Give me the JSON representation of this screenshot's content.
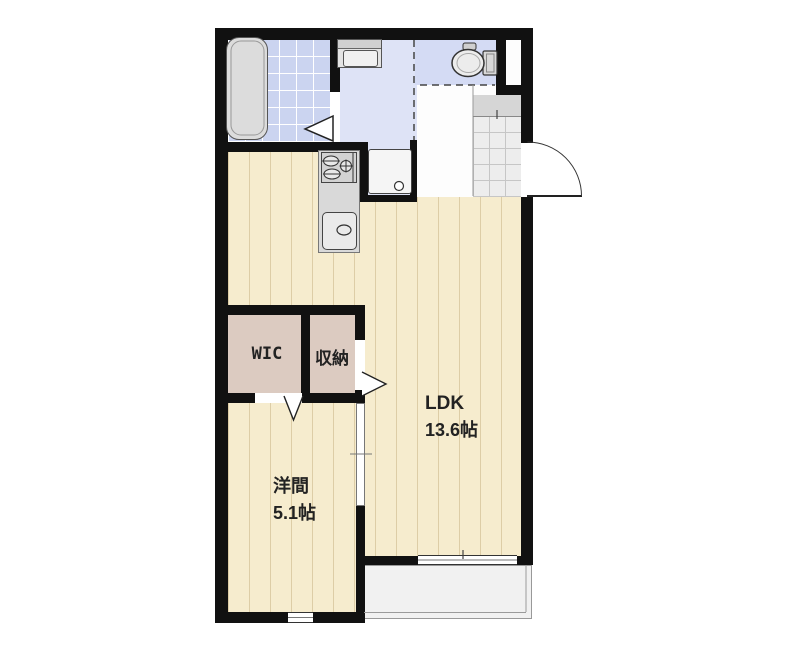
{
  "floorplan": {
    "type": "apartment-floor-plan",
    "rooms": [
      {
        "name": "LDK",
        "area": "13.6帖"
      },
      {
        "name": "洋間",
        "area": "5.1帖"
      },
      {
        "name": "WIC",
        "area": ""
      },
      {
        "name": "収納",
        "area": ""
      }
    ],
    "fixtures": [
      "bathtub",
      "vanity-sink",
      "washing-machine-pan",
      "toilet",
      "kitchen-stove",
      "kitchen-sink",
      "entrance-door",
      "bathroom-folding-door",
      "sliding-door",
      "balcony",
      "genkan-tile",
      "windows"
    ],
    "colors": {
      "wall": "#111111",
      "wood": "#f6ecce",
      "wood_line": "#ddcda6",
      "bath_tile": "#cbd4f0",
      "washroom": "#dee3f6",
      "toilet": "#d4dbf4",
      "closet_floor": "#dccbc1",
      "genkan_tile": "#ededed",
      "balcony": "#f1f1f1",
      "fixture": "#dcdcdc",
      "label": "#222222"
    }
  }
}
